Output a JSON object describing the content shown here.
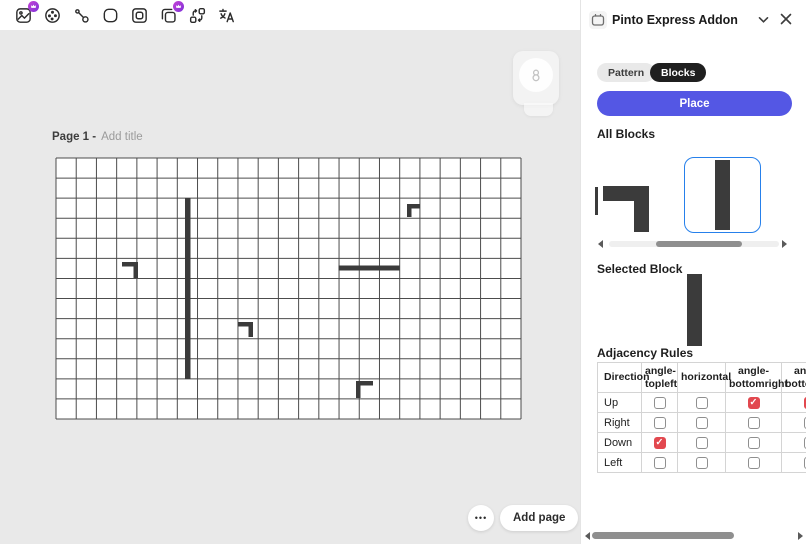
{
  "colors": {
    "accent": "#5457e4",
    "selection_blue": "#2680eb",
    "check_red": "#e2484f",
    "block": "#3b3b3b",
    "grid_line": "#4c4c4c",
    "premium_badge": "#9b36d6"
  },
  "toolbar": {
    "icons": [
      {
        "name": "replace-media",
        "premium": true
      },
      {
        "name": "color-wheel",
        "premium": false
      },
      {
        "name": "draw-path",
        "premium": false
      },
      {
        "name": "shape",
        "premium": false
      },
      {
        "name": "frame",
        "premium": false
      },
      {
        "name": "duplicate",
        "premium": true
      },
      {
        "name": "shuffle",
        "premium": false
      },
      {
        "name": "translate",
        "premium": false
      }
    ]
  },
  "workspace": {
    "page_label": "Page 1 -",
    "title_placeholder": "Add title",
    "more_button_label": "•••",
    "add_page_label": "Add page",
    "grid": {
      "cols": 23,
      "rows": 13,
      "width": 465,
      "height": 261
    },
    "blocks": [
      {
        "type": "vertical-bar",
        "x": 129,
        "y": 40,
        "w": 5.5,
        "h": 181
      },
      {
        "type": "angle-topright",
        "x": 66,
        "y": 104,
        "size": 16,
        "t": 4.5
      },
      {
        "type": "angle-topleft",
        "x": 351,
        "y": 46,
        "size": 13,
        "t": 4.5
      },
      {
        "type": "horizontal-bar",
        "x": 282.5,
        "y": 107.5,
        "w": 61,
        "h": 5
      },
      {
        "type": "angle-topright",
        "x": 182,
        "y": 164,
        "size": 15,
        "t": 4.5
      },
      {
        "type": "angle-topleft",
        "x": 300,
        "y": 223,
        "size": 17,
        "t": 4.5
      }
    ]
  },
  "panel": {
    "title": "Pinto Express Addon",
    "tabs": [
      {
        "label": "Pattern",
        "active": false
      },
      {
        "label": "Blocks",
        "active": true
      }
    ],
    "place_button_label": "Place",
    "all_blocks_label": "All Blocks",
    "carousel": {
      "items": [
        {
          "name": "angle-topright",
          "selected": false
        },
        {
          "name": "vertical",
          "selected": true
        }
      ]
    },
    "selected_block_label": "Selected Block",
    "selected_block": "vertical",
    "adjacency_label": "Adjacency Rules",
    "table": {
      "columns": [
        "Direction",
        "angle-topleft",
        "horizontal",
        "angle-bottomright",
        "angle-bottomleft"
      ],
      "rows": [
        {
          "direction": "Up",
          "checks": [
            false,
            false,
            true,
            true
          ]
        },
        {
          "direction": "Right",
          "checks": [
            false,
            false,
            false,
            false
          ]
        },
        {
          "direction": "Down",
          "checks": [
            true,
            false,
            false,
            false
          ]
        },
        {
          "direction": "Left",
          "checks": [
            false,
            false,
            false,
            false
          ]
        }
      ]
    }
  }
}
